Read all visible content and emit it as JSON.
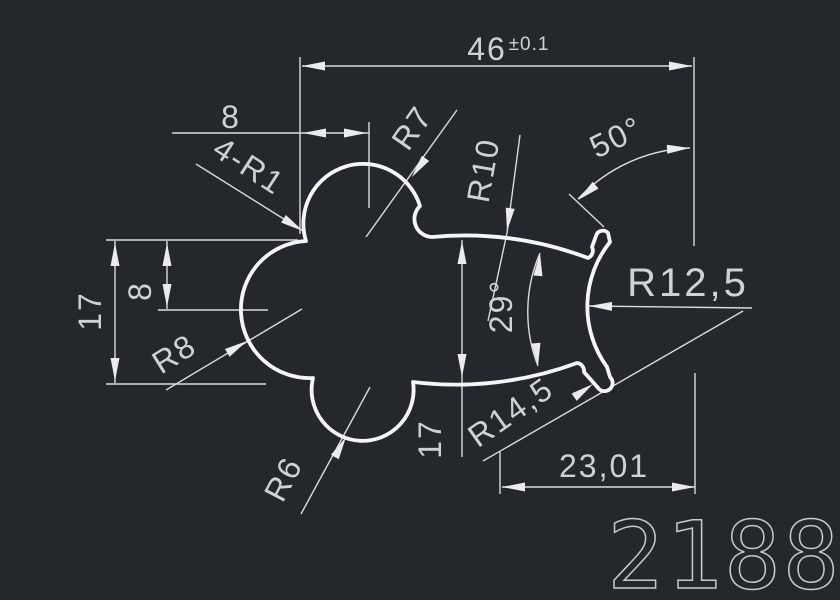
{
  "title_block": {
    "part_number": "2188"
  },
  "dims": {
    "top_width": {
      "value": "46",
      "tolerance": "±0.1"
    },
    "top_offset": {
      "value": "8"
    },
    "fillet_note": {
      "value": "4-R1"
    },
    "top_lobe_radius": {
      "value": "R7"
    },
    "neck_radius": {
      "value": "R10"
    },
    "tip_angle": {
      "value": "50°"
    },
    "left_height": {
      "value": "17"
    },
    "left_offset": {
      "value": "8"
    },
    "left_lobe_radius": {
      "value": "R8"
    },
    "neck_angle": {
      "value": "29°"
    },
    "tip_radius": {
      "value": "R12,5"
    },
    "bottom_lobe_radius": {
      "value": "R6"
    },
    "neck_height": {
      "value": "17"
    },
    "hook_radius": {
      "value": "R14,5"
    },
    "bottom_width": {
      "value": "23,01"
    }
  },
  "colors": {
    "background": "#24282d",
    "profile_line": "#f4f5f6",
    "dimension_line": "#d9dbde",
    "text": "#ced2d6"
  }
}
